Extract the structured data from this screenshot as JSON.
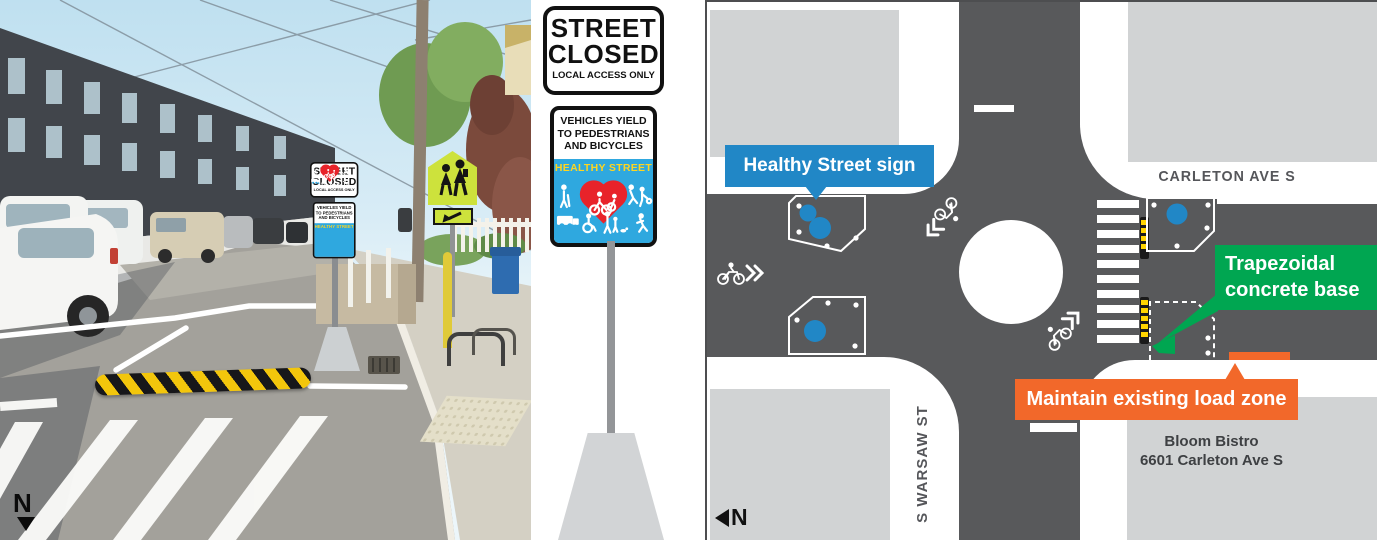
{
  "sign": {
    "street": "STREET",
    "closed": "CLOSED",
    "local_access": "LOCAL ACCESS ONLY",
    "yield_lines": [
      "VEHICLES YIELD",
      "TO PEDESTRIANS",
      "AND BICYCLES"
    ],
    "healthy_street": "HEALTHY STREET"
  },
  "photo": {
    "north_label": "N"
  },
  "map": {
    "north_label": "N",
    "callouts": {
      "sign_label": "Healthy Street sign",
      "base_label": "Trapezoidal concrete base",
      "load_zone_label": "Maintain existing load zone"
    },
    "streets": {
      "carleton": "CARLETON AVE S",
      "warsaw": "S WARSAW ST"
    },
    "business": {
      "name": "Bloom Bistro",
      "address": "6601 Carleton Ave S"
    },
    "colors": {
      "road_gray": "#58595B",
      "block_gray": "#D1D3D4",
      "callout_blue": "#2187C6",
      "callout_green": "#00A651",
      "callout_orange": "#F2682A",
      "sign_panel_blue": "#2FA8DF",
      "heart_red": "#E8232A",
      "healthy_yellow": "#FFD520",
      "hazard_yellow": "#FFD400"
    }
  }
}
